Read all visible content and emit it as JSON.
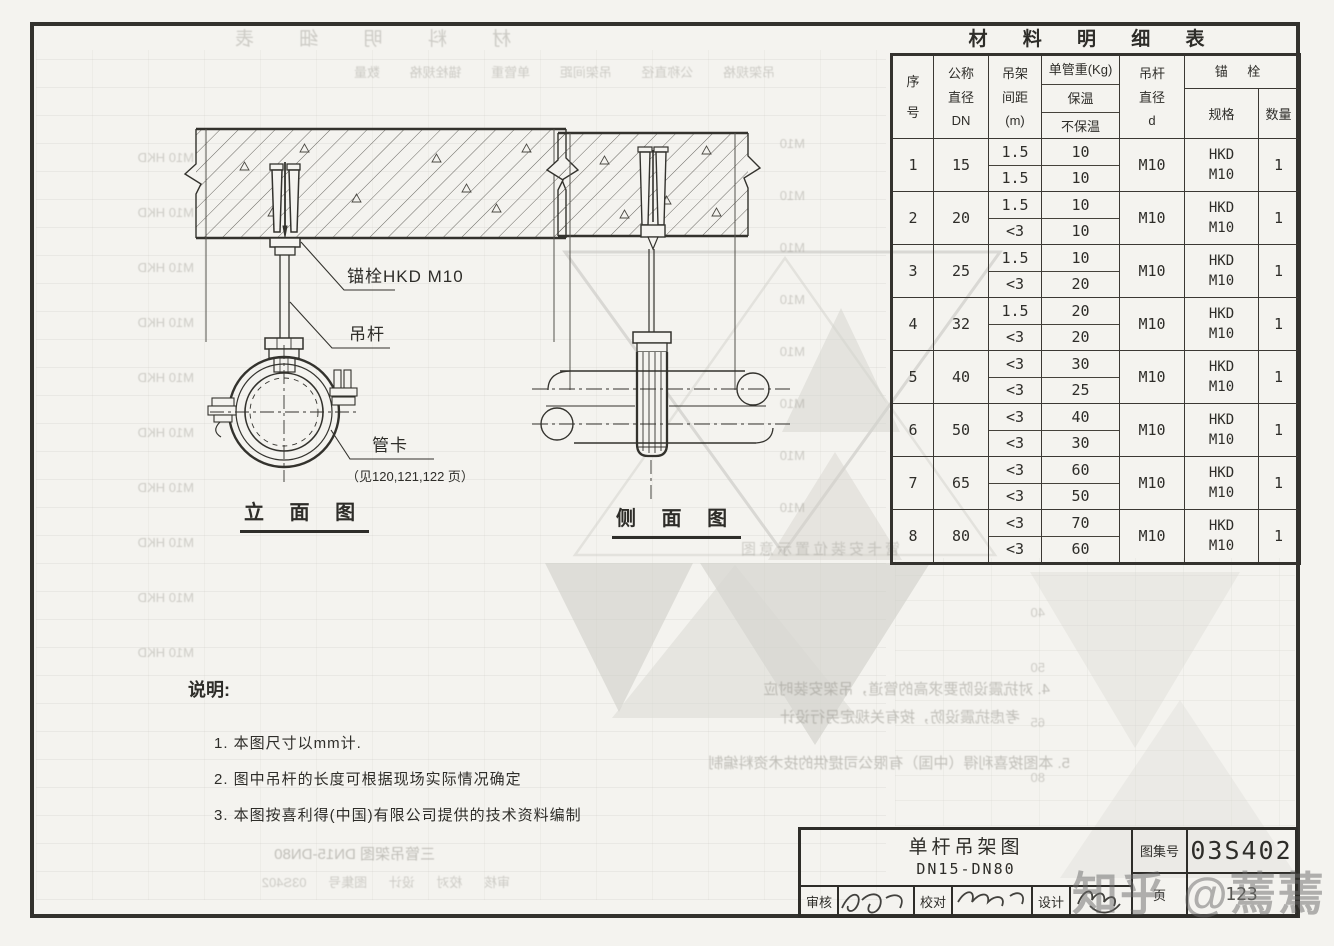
{
  "materials_table": {
    "title": "材 料 明 细 表",
    "headers": {
      "no": [
        "序",
        "号"
      ],
      "dn": [
        "公称",
        "直径",
        "DN"
      ],
      "spacing": [
        "吊架",
        "间距",
        "(m)"
      ],
      "weight_title": "单管重(Kg)",
      "weight_sub": [
        "保温",
        "不保温"
      ],
      "rod": [
        "吊杆",
        "直径",
        "d"
      ],
      "anchor": "锚 栓",
      "spec": "规格",
      "qty": "数量"
    },
    "rows": [
      {
        "no": "1",
        "dn": "15",
        "spacing": [
          "1.5",
          "1.5"
        ],
        "weight": [
          "10",
          "10"
        ],
        "rod": "M10",
        "spec": [
          "HKD",
          "M10"
        ],
        "qty": "1"
      },
      {
        "no": "2",
        "dn": "20",
        "spacing": [
          "1.5",
          "<3"
        ],
        "weight": [
          "10",
          "10"
        ],
        "rod": "M10",
        "spec": [
          "HKD",
          "M10"
        ],
        "qty": "1"
      },
      {
        "no": "3",
        "dn": "25",
        "spacing": [
          "1.5",
          "<3"
        ],
        "weight": [
          "10",
          "20"
        ],
        "rod": "M10",
        "spec": [
          "HKD",
          "M10"
        ],
        "qty": "1"
      },
      {
        "no": "4",
        "dn": "32",
        "spacing": [
          "1.5",
          "<3"
        ],
        "weight": [
          "20",
          "20"
        ],
        "rod": "M10",
        "spec": [
          "HKD",
          "M10"
        ],
        "qty": "1"
      },
      {
        "no": "5",
        "dn": "40",
        "spacing": [
          "<3",
          "<3"
        ],
        "weight": [
          "30",
          "25"
        ],
        "rod": "M10",
        "spec": [
          "HKD",
          "M10"
        ],
        "qty": "1"
      },
      {
        "no": "6",
        "dn": "50",
        "spacing": [
          "<3",
          "<3"
        ],
        "weight": [
          "40",
          "30"
        ],
        "rod": "M10",
        "spec": [
          "HKD",
          "M10"
        ],
        "qty": "1"
      },
      {
        "no": "7",
        "dn": "65",
        "spacing": [
          "<3",
          "<3"
        ],
        "weight": [
          "60",
          "50"
        ],
        "rod": "M10",
        "spec": [
          "HKD",
          "M10"
        ],
        "qty": "1"
      },
      {
        "no": "8",
        "dn": "80",
        "spacing": [
          "<3",
          "<3"
        ],
        "weight": [
          "70",
          "60"
        ],
        "rod": "M10",
        "spec": [
          "HKD",
          "M10"
        ],
        "qty": "1"
      }
    ]
  },
  "elevation": {
    "title": "立 面 图",
    "anchor_label": "锚栓HKD M10",
    "rod_label": "吊杆",
    "clamp_label": "管卡",
    "clamp_ref": "（见120,121,122 页）"
  },
  "side": {
    "title": "侧 面 图"
  },
  "notes": {
    "heading": "说明:",
    "items": [
      "1. 本图尺寸以mm计.",
      "2. 图中吊杆的长度可根据现场实际情况确定",
      "3. 本图按喜利得(中国)有限公司提供的技术资料编制"
    ]
  },
  "title_block": {
    "drawing_title_line1": "单杆吊架图",
    "drawing_title_line2": "DN15-DN80",
    "reviewer_label": "审核",
    "checker_label": "校对",
    "designer_label": "设计",
    "atlas_no_label": "图集号",
    "atlas_no": "03S402",
    "page_label": "页",
    "page_no": "123"
  },
  "watermark": "知乎 @蔫蔫",
  "ghost": {
    "fragments": [
      "材 料 明 细 表",
      "吊架规格  公称直径  吊架间距  单管重  锚栓规格  数量",
      "M10 HKD\nM10 HKD\nM10 HKD\nM10 HKD\nM10 HKD\nM10 HKD\nM10 HKD\nM10 HKD\nM10 HKD\nM10 HKD",
      "M10\nM10\nM10\nM10\nM10\nM10\nM10\nM10",
      "管卡安装位置示意图",
      "4. 对抗震设防要求高的管道，吊架安装时应",
      "考虑抗震设防，按有关规定另行设计",
      "5. 本图按喜利得（中国）有限公司提供的技术资料编制",
      "三管吊架图  DN15-DN80",
      "审核  校对  设计  图集号 03S402",
      "40\n50\n65\n80"
    ]
  }
}
